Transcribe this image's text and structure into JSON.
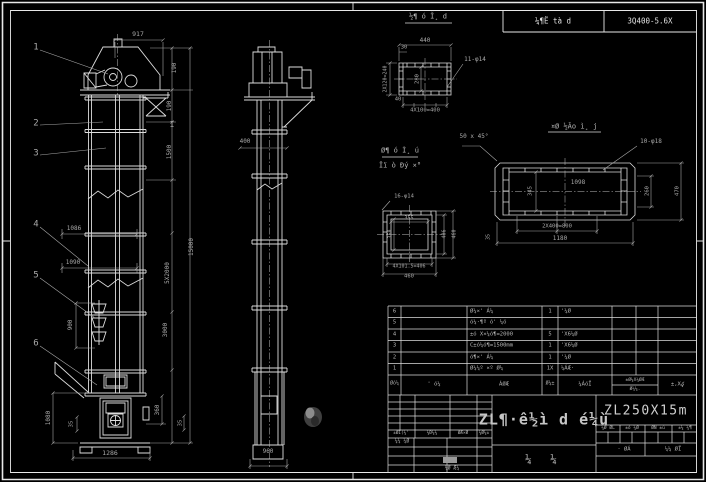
{
  "sheet": {
    "background": "#000000",
    "line_color": "#e2e2e2",
    "dim_color": "#a8a8a8",
    "header": {
      "left_cell": "¼¶Ë tà d",
      "right_cell": "3Q400-5.6X"
    }
  },
  "title_block": {
    "drawing_title": "ZL¶·ê½ì d é¼ù",
    "type_label": "¼    ¼",
    "drawing_no": "ZL250X15m",
    "band_cells": [
      "¼Ø ØL",
      "±ó ¼Ø",
      "ØÑ ±ú",
      "±¼ ¼¶"
    ],
    "band2_cells": [
      "· ØÁ",
      "¼¼ ØÏ"
    ],
    "left_row_cells": [
      "±ØÏ(¼'",
      "¼Ð¼¼",
      "ØÆ×Ø",
      "¼Ø¼±"
    ],
    "left_label": "¼¼ ¼Ø",
    "left_bottom_label": "¼Ø Æ¼"
  },
  "bom": {
    "headers": {
      "no": "Øó¼",
      "code": "' ó¼",
      "name": "ÁØÆ",
      "qty": "Ø¼±",
      "mat": "¼ÁóÏ",
      "w_top": "±Ø¼X¼ØÆ",
      "w_bottom": "Ø¼¼.",
      "note": "±,Xؼ"
    },
    "rows": [
      {
        "no": "6",
        "code": "",
        "name": "Ø¼×' Á¼",
        "qty": "1",
        "mat": "'¼Ø"
      },
      {
        "no": "5",
        "code": "",
        "name": "ó¼·¶º ó' ¼ó",
        "qty": "",
        "mat": ""
      },
      {
        "no": "4",
        "code": "",
        "name": "±ó X×¼ó¶=2000",
        "qty": "5",
        "mat": "'X6¼Ø"
      },
      {
        "no": "3",
        "code": "",
        "name": "C±ó¼ó¶=1500mm",
        "qty": "1",
        "mat": "'X6¼Ø"
      },
      {
        "no": "2",
        "code": "",
        "name": "ó¶×' Á¼",
        "qty": "1",
        "mat": "'¼Ø"
      },
      {
        "no": "1",
        "code": "",
        "name": "Ø¼¼º ×º Ø¼",
        "qty": "1X",
        "mat": "¼ÁÆ·"
      }
    ]
  },
  "labels": [
    {
      "n": "balloon-1",
      "t": "1",
      "x": 36,
      "y": 48,
      "s": 9
    },
    {
      "n": "balloon-2",
      "t": "2",
      "x": 36,
      "y": 124,
      "s": 9
    },
    {
      "n": "balloon-3",
      "t": "3",
      "x": 36,
      "y": 154,
      "s": 9
    },
    {
      "n": "balloon-4",
      "t": "4",
      "x": 36,
      "y": 225,
      "s": 9
    },
    {
      "n": "balloon-5",
      "t": "5",
      "x": 36,
      "y": 276,
      "s": 9
    },
    {
      "n": "balloon-6",
      "t": "6",
      "x": 36,
      "y": 344,
      "s": 9
    },
    {
      "n": "dim-917",
      "t": "917",
      "x": 138,
      "y": 34,
      "s": 6.5
    },
    {
      "n": "dim-190-a",
      "t": "190",
      "x": 175,
      "y": 68,
      "r": -90,
      "s": 6
    },
    {
      "n": "dim-190-b",
      "t": "190",
      "x": 170,
      "y": 106,
      "r": -90,
      "s": 6
    },
    {
      "n": "dim-1500",
      "t": "1500",
      "x": 170,
      "y": 152,
      "r": -90,
      "s": 6
    },
    {
      "n": "dim-15000",
      "t": "15000",
      "x": 192,
      "y": 247,
      "r": -90,
      "s": 6
    },
    {
      "n": "dim-5x2000",
      "t": "5X2000",
      "x": 168,
      "y": 273,
      "r": -90,
      "s": 6
    },
    {
      "n": "dim-3000",
      "t": "3000",
      "x": 166,
      "y": 330,
      "r": -90,
      "s": 6
    },
    {
      "n": "dim-1086",
      "t": "1086",
      "x": 74,
      "y": 229,
      "s": 6
    },
    {
      "n": "dim-1090",
      "t": "1090",
      "x": 73,
      "y": 263,
      "s": 6
    },
    {
      "n": "dim-900",
      "t": "900",
      "x": 71,
      "y": 325,
      "r": -90,
      "s": 6
    },
    {
      "n": "symbol-ibeam",
      "t": "I",
      "x": 172,
      "y": 125,
      "s": 8
    },
    {
      "n": "dim-1080",
      "t": "1080",
      "x": 49,
      "y": 418,
      "r": -90,
      "s": 6
    },
    {
      "n": "dim-35-boot-left",
      "t": "35",
      "x": 72,
      "y": 424,
      "r": -90,
      "s": 5.5
    },
    {
      "n": "dim-1286",
      "t": "1286",
      "x": 110,
      "y": 453,
      "s": 6.5
    },
    {
      "n": "dim-360",
      "t": "360",
      "x": 158,
      "y": 410,
      "r": -90,
      "s": 6
    },
    {
      "n": "dim-35-boot-right",
      "t": "35",
      "x": 181,
      "y": 423,
      "r": -90,
      "s": 5.5
    },
    {
      "n": "dim-400-side",
      "t": "400",
      "x": 245,
      "y": 142,
      "s": 6
    },
    {
      "n": "dim-960",
      "t": "960",
      "x": 268,
      "y": 452,
      "s": 6
    },
    {
      "n": "detail-a-title",
      "t": "½¶ ó Ĭ¸ d",
      "x": 428,
      "y": 17,
      "s": 7,
      "c": "text"
    },
    {
      "n": "dim-440",
      "t": "440",
      "x": 425,
      "y": 41,
      "s": 6
    },
    {
      "n": "dim-30",
      "t": "30",
      "x": 404,
      "y": 48,
      "s": 5.5
    },
    {
      "n": "dim-11-d14",
      "t": "11-φ14",
      "x": 475,
      "y": 60,
      "s": 6
    },
    {
      "n": "dim-280",
      "t": "280",
      "x": 418,
      "y": 79,
      "r": -90,
      "s": 5.5
    },
    {
      "n": "dim-2x120",
      "t": "2X120=240",
      "x": 386,
      "y": 79,
      "r": -90,
      "s": 5
    },
    {
      "n": "dim-40",
      "t": "40",
      "x": 398,
      "y": 100,
      "s": 5.5
    },
    {
      "n": "dim-4x100",
      "t": "4X100=400",
      "x": 425,
      "y": 111,
      "s": 5.5
    },
    {
      "n": "detail-b-title",
      "t": "¤Ø ½Ão ì¸ j",
      "x": 574,
      "y": 127,
      "s": 7,
      "c": "text"
    },
    {
      "n": "note-chamfer",
      "t": "50 x 45°",
      "x": 474,
      "y": 137,
      "s": 6
    },
    {
      "n": "dim-10-d18",
      "t": "10-φ18",
      "x": 651,
      "y": 142,
      "s": 6
    },
    {
      "n": "dim-1098",
      "t": "1098",
      "x": 578,
      "y": 183,
      "s": 6
    },
    {
      "n": "dim-345",
      "t": "345",
      "x": 531,
      "y": 191,
      "r": -90,
      "s": 5.5
    },
    {
      "n": "dim-260",
      "t": "260",
      "x": 648,
      "y": 191,
      "r": -90,
      "s": 5.5
    },
    {
      "n": "dim-470",
      "t": "470",
      "x": 678,
      "y": 191,
      "r": -90,
      "s": 5.5
    },
    {
      "n": "dim-2x400",
      "t": "2X400=800",
      "x": 557,
      "y": 227,
      "s": 5.5
    },
    {
      "n": "dim-1180",
      "t": "1180",
      "x": 560,
      "y": 239,
      "s": 6
    },
    {
      "n": "dim-35-plate",
      "t": "35",
      "x": 489,
      "y": 237,
      "r": -90,
      "s": 5
    },
    {
      "n": "detail-c-title-1",
      "t": "Ø¶ ó Ì¸ ú",
      "x": 400,
      "y": 151,
      "s": 7,
      "c": "text"
    },
    {
      "n": "detail-c-title-2",
      "t": "Ïï ò Ðý ×°",
      "x": 400,
      "y": 166,
      "s": 7,
      "c": "text"
    },
    {
      "n": "dim-16-d14",
      "t": "16-φ14",
      "x": 404,
      "y": 197,
      "s": 5.5
    },
    {
      "n": "dim-355",
      "t": "355",
      "x": 409,
      "y": 219,
      "s": 5
    },
    {
      "n": "dim-350",
      "t": "350",
      "x": 391,
      "y": 234,
      "r": -90,
      "s": 5
    },
    {
      "n": "dim-406-v",
      "t": "406",
      "x": 445,
      "y": 234,
      "r": -90,
      "s": 5
    },
    {
      "n": "dim-460-v",
      "t": "460",
      "x": 455,
      "y": 234,
      "r": -90,
      "s": 5
    },
    {
      "n": "dim-4x101",
      "t": "4X101.5=406",
      "x": 409,
      "y": 267,
      "s": 5
    },
    {
      "n": "dim-460-h",
      "t": "460",
      "x": 409,
      "y": 277,
      "s": 5.5
    }
  ]
}
